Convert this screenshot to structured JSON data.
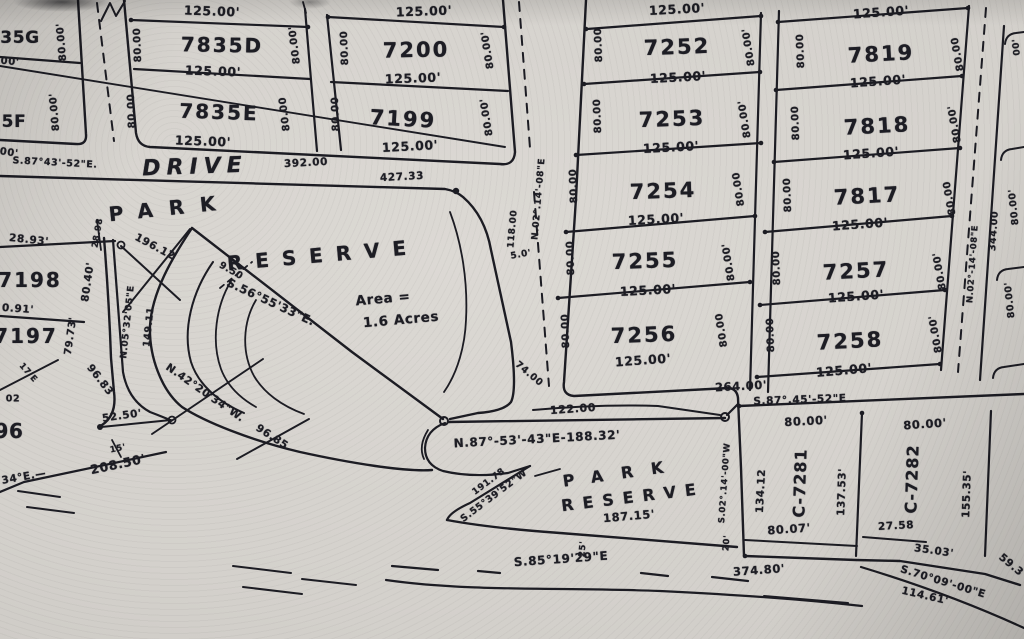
{
  "map": {
    "kind": "scanned subdivision plat map",
    "street_names_visible": [
      "DRIVE"
    ],
    "park_area_note": "Area = 1.6 Acres",
    "lot_numbers_visible": [
      "35G",
      "5F",
      "7835D",
      "7835E",
      "7200",
      "7199",
      "7252",
      "7253",
      "7254",
      "7255",
      "7256",
      "7819",
      "7818",
      "7817",
      "7257",
      "7258",
      "7198",
      "7197",
      "96",
      "C-7281",
      "C-7282"
    ],
    "ink_color": "#1c1c23",
    "paper_color": "#d4d1cc"
  },
  "labels": [
    {
      "t": "35G",
      "x": 20,
      "y": 38,
      "r": 0,
      "s": 17,
      "n": "lot-number-35g"
    },
    {
      "t": "00'",
      "x": 10,
      "y": 62,
      "r": 5,
      "s": 10
    },
    {
      "t": "80.00'",
      "x": 62,
      "y": 42,
      "r": -95,
      "s": 10
    },
    {
      "t": "5F",
      "x": 14,
      "y": 122,
      "r": 0,
      "s": 17,
      "n": "lot-number-5f"
    },
    {
      "t": "00'",
      "x": 9,
      "y": 153,
      "r": 8,
      "s": 10
    },
    {
      "t": "80.00'",
      "x": 55,
      "y": 112,
      "r": -95,
      "s": 10
    },
    {
      "t": "125.00'",
      "x": 212,
      "y": 11,
      "r": 2,
      "s": 12.5
    },
    {
      "t": "7835D",
      "x": 222,
      "y": 45,
      "r": 1,
      "s": 20,
      "ls": 2,
      "n": "lot-number-7835d"
    },
    {
      "t": "80.00",
      "x": 138,
      "y": 45,
      "r": -92,
      "s": 10
    },
    {
      "t": "80.00'",
      "x": 295,
      "y": 45,
      "r": -97,
      "s": 10
    },
    {
      "t": "125.00'",
      "x": 213,
      "y": 71,
      "r": 2,
      "s": 12.5
    },
    {
      "t": "7835E",
      "x": 219,
      "y": 112,
      "r": 2,
      "s": 20,
      "ls": 2,
      "n": "lot-number-7835e"
    },
    {
      "t": "80.00",
      "x": 132,
      "y": 111,
      "r": -92,
      "s": 10
    },
    {
      "t": "80.00",
      "x": 285,
      "y": 114,
      "r": -97,
      "s": 10
    },
    {
      "t": "125.00'",
      "x": 203,
      "y": 141,
      "r": 2,
      "s": 12.5
    },
    {
      "t": "125.00'",
      "x": 424,
      "y": 11,
      "r": -2,
      "s": 12.5
    },
    {
      "t": "7200",
      "x": 416,
      "y": 50,
      "r": -1,
      "s": 21,
      "ls": 2,
      "n": "lot-number-7200"
    },
    {
      "t": "80.00",
      "x": 345,
      "y": 48,
      "r": -92,
      "s": 10
    },
    {
      "t": "80.00'",
      "x": 488,
      "y": 50,
      "r": -99,
      "s": 10
    },
    {
      "t": "125.00'",
      "x": 413,
      "y": 78,
      "r": -2,
      "s": 12.5
    },
    {
      "t": "7199",
      "x": 403,
      "y": 119,
      "r": 3,
      "s": 21,
      "ls": 2,
      "n": "lot-number-7199"
    },
    {
      "t": "80.00",
      "x": 336,
      "y": 114,
      "r": -92,
      "s": 10
    },
    {
      "t": "80.00'",
      "x": 487,
      "y": 117,
      "r": -99,
      "s": 10
    },
    {
      "t": "125.00'",
      "x": 410,
      "y": 146,
      "r": -3,
      "s": 12.5
    },
    {
      "t": "S.87°43'-52\"E.",
      "x": 55,
      "y": 163,
      "r": 3,
      "s": 9.5,
      "n": "bearing-label"
    },
    {
      "t": "DRIVE",
      "x": 195,
      "y": 167,
      "r": -2,
      "s": 22,
      "ls": 6,
      "it": 1,
      "n": "street-name-drive"
    },
    {
      "t": "392.00",
      "x": 306,
      "y": 163,
      "r": -3,
      "s": 10.5
    },
    {
      "t": "427.33",
      "x": 402,
      "y": 177,
      "r": -3,
      "s": 10.5
    },
    {
      "t": "PARK",
      "x": 170,
      "y": 208,
      "r": -6,
      "s": 20,
      "ls": 16,
      "n": "park-reserve-west-label"
    },
    {
      "t": "RESERVE",
      "x": 323,
      "y": 255,
      "r": -5,
      "s": 20,
      "ls": 13,
      "n": "park-reserve-west-label"
    },
    {
      "t": "Area =",
      "x": 383,
      "y": 299,
      "r": -5,
      "s": 13.5,
      "n": "area-label"
    },
    {
      "t": "1.6 Acres",
      "x": 401,
      "y": 320,
      "r": -5,
      "s": 13.5,
      "n": "area-label"
    },
    {
      "t": "S.56°55'33\"E.",
      "x": 271,
      "y": 302,
      "r": 25,
      "s": 11.5,
      "n": "bearing-label"
    },
    {
      "t": "196.12",
      "x": 155,
      "y": 247,
      "r": 28,
      "s": 10.5
    },
    {
      "t": "28.98",
      "x": 98,
      "y": 233,
      "r": -80,
      "s": 8.5
    },
    {
      "t": "28.93'",
      "x": 29,
      "y": 240,
      "r": 6,
      "s": 10.5
    },
    {
      "t": "7198",
      "x": 30,
      "y": 280,
      "r": 0,
      "s": 20,
      "ls": 2,
      "n": "lot-number-7198"
    },
    {
      "t": "80.40'",
      "x": 88,
      "y": 282,
      "r": -82,
      "s": 10.5
    },
    {
      "t": "0.91'",
      "x": 18,
      "y": 309,
      "r": 4,
      "s": 10.5
    },
    {
      "t": "7197",
      "x": 26,
      "y": 336,
      "r": 0,
      "s": 20,
      "ls": 2,
      "n": "lot-number-7197"
    },
    {
      "t": "79.73'",
      "x": 71,
      "y": 336,
      "r": -82,
      "s": 10
    },
    {
      "t": "N.05°32'05\"E",
      "x": 128,
      "y": 322,
      "r": -84,
      "s": 9,
      "n": "bearing-label"
    },
    {
      "t": "149.11",
      "x": 149,
      "y": 327,
      "r": -84,
      "s": 9.5
    },
    {
      "t": "9.50",
      "x": 231,
      "y": 271,
      "r": 30,
      "s": 9.5
    },
    {
      "t": "N.42°20'34\"W.",
      "x": 205,
      "y": 393,
      "r": 35,
      "s": 10.5,
      "n": "bearing-label"
    },
    {
      "t": "96.85",
      "x": 272,
      "y": 437,
      "r": 33,
      "s": 10.5
    },
    {
      "t": "96.83",
      "x": 100,
      "y": 380,
      "r": 52,
      "s": 10.5
    },
    {
      "t": "52.50'",
      "x": 122,
      "y": 416,
      "r": -8,
      "s": 10.5
    },
    {
      "t": "15'",
      "x": 118,
      "y": 449,
      "r": -12,
      "s": 8.5
    },
    {
      "t": "208.50'",
      "x": 118,
      "y": 464,
      "r": -12,
      "s": 12.5
    },
    {
      "t": "34°E.—",
      "x": 24,
      "y": 477,
      "r": -10,
      "s": 10.5
    },
    {
      "t": "17'E",
      "x": 28,
      "y": 373,
      "r": 48,
      "s": 8.5
    },
    {
      "t": "02",
      "x": 13,
      "y": 399,
      "r": 0,
      "s": 9.5
    },
    {
      "t": "96",
      "x": 9,
      "y": 431,
      "r": 0,
      "s": 20,
      "n": "lot-number-96"
    },
    {
      "t": "N.02°.14'-08\"E",
      "x": 539,
      "y": 199,
      "r": -85,
      "s": 9,
      "n": "bearing-label"
    },
    {
      "t": "118.00",
      "x": 513,
      "y": 229,
      "r": -85,
      "s": 9
    },
    {
      "t": "5.0'",
      "x": 521,
      "y": 255,
      "r": -10,
      "s": 9
    },
    {
      "t": "74.00",
      "x": 529,
      "y": 374,
      "r": 40,
      "s": 9.5
    },
    {
      "t": "122.00",
      "x": 573,
      "y": 409,
      "r": -4,
      "s": 11
    },
    {
      "t": "125.00'",
      "x": 677,
      "y": 9,
      "r": -3,
      "s": 12.5
    },
    {
      "t": "7252",
      "x": 677,
      "y": 47,
      "r": -2,
      "s": 21,
      "ls": 2,
      "n": "lot-number-7252"
    },
    {
      "t": "80.00",
      "x": 599,
      "y": 45,
      "r": -92,
      "s": 10
    },
    {
      "t": "80.00'",
      "x": 749,
      "y": 47,
      "r": -99,
      "s": 10
    },
    {
      "t": "125.00'",
      "x": 678,
      "y": 77,
      "r": -3,
      "s": 12.5
    },
    {
      "t": "7253",
      "x": 672,
      "y": 119,
      "r": -2,
      "s": 21,
      "ls": 2,
      "n": "lot-number-7253"
    },
    {
      "t": "80.00",
      "x": 598,
      "y": 116,
      "r": -92,
      "s": 10
    },
    {
      "t": "80.00'",
      "x": 745,
      "y": 119,
      "r": -99,
      "s": 10
    },
    {
      "t": "125.00'",
      "x": 671,
      "y": 147,
      "r": -3,
      "s": 12.5
    },
    {
      "t": "7254",
      "x": 663,
      "y": 191,
      "r": -2,
      "s": 21,
      "ls": 2,
      "n": "lot-number-7254"
    },
    {
      "t": "80.00",
      "x": 574,
      "y": 186,
      "r": -92,
      "s": 10
    },
    {
      "t": "80.00",
      "x": 739,
      "y": 189,
      "r": -99,
      "s": 10
    },
    {
      "t": "125.00'",
      "x": 656,
      "y": 219,
      "r": -3,
      "s": 12.5
    },
    {
      "t": "7255",
      "x": 645,
      "y": 261,
      "r": -2,
      "s": 21,
      "ls": 2,
      "n": "lot-number-7255"
    },
    {
      "t": "80.00",
      "x": 571,
      "y": 258,
      "r": -92,
      "s": 10
    },
    {
      "t": "80.00'",
      "x": 729,
      "y": 262,
      "r": -99,
      "s": 10
    },
    {
      "t": "125.00'",
      "x": 648,
      "y": 290,
      "r": -3,
      "s": 12.5
    },
    {
      "t": "7256",
      "x": 644,
      "y": 335,
      "r": -2,
      "s": 21,
      "ls": 2,
      "n": "lot-number-7256"
    },
    {
      "t": "80.00",
      "x": 566,
      "y": 331,
      "r": -92,
      "s": 10
    },
    {
      "t": "80.00",
      "x": 722,
      "y": 330,
      "r": -99,
      "s": 10
    },
    {
      "t": "125.00'",
      "x": 643,
      "y": 360,
      "r": -4,
      "s": 12.5
    },
    {
      "t": "264.00'",
      "x": 741,
      "y": 386,
      "r": -3,
      "s": 11.5
    },
    {
      "t": "S.87°.45'-52\"E",
      "x": 800,
      "y": 400,
      "r": -2,
      "s": 10.5,
      "n": "bearing-label"
    },
    {
      "t": "125.00'",
      "x": 881,
      "y": 12,
      "r": -4,
      "s": 12.5
    },
    {
      "t": "7819",
      "x": 881,
      "y": 54,
      "r": -3,
      "s": 21,
      "ls": 2,
      "n": "lot-number-7819"
    },
    {
      "t": "80.00",
      "x": 801,
      "y": 51,
      "r": -92,
      "s": 10
    },
    {
      "t": "80.00",
      "x": 958,
      "y": 54,
      "r": -100,
      "s": 10
    },
    {
      "t": "125.00'",
      "x": 878,
      "y": 81,
      "r": -4,
      "s": 12.5
    },
    {
      "t": "7818",
      "x": 877,
      "y": 126,
      "r": -3,
      "s": 21,
      "ls": 2,
      "n": "lot-number-7818"
    },
    {
      "t": "80.00",
      "x": 796,
      "y": 123,
      "r": -92,
      "s": 10
    },
    {
      "t": "80.00'",
      "x": 955,
      "y": 124,
      "r": -100,
      "s": 10
    },
    {
      "t": "125.00'",
      "x": 871,
      "y": 153,
      "r": -4,
      "s": 12.5
    },
    {
      "t": "7817",
      "x": 867,
      "y": 196,
      "r": -3,
      "s": 21,
      "ls": 2,
      "n": "lot-number-7817"
    },
    {
      "t": "80.00",
      "x": 788,
      "y": 195,
      "r": -92,
      "s": 10
    },
    {
      "t": "80.00",
      "x": 950,
      "y": 198,
      "r": -100,
      "s": 10
    },
    {
      "t": "125.00'",
      "x": 860,
      "y": 224,
      "r": -4,
      "s": 12.5
    },
    {
      "t": "7257",
      "x": 856,
      "y": 271,
      "r": -3,
      "s": 21,
      "ls": 2,
      "n": "lot-number-7257"
    },
    {
      "t": "80.00",
      "x": 777,
      "y": 268,
      "r": -92,
      "s": 10
    },
    {
      "t": "80.00'",
      "x": 940,
      "y": 271,
      "r": -100,
      "s": 10
    },
    {
      "t": "125.00'",
      "x": 856,
      "y": 296,
      "r": -4,
      "s": 12.5
    },
    {
      "t": "7258",
      "x": 850,
      "y": 341,
      "r": -3,
      "s": 21,
      "ls": 2,
      "n": "lot-number-7258"
    },
    {
      "t": "80.00",
      "x": 771,
      "y": 335,
      "r": -92,
      "s": 10
    },
    {
      "t": "80.00'",
      "x": 936,
      "y": 334,
      "r": -100,
      "s": 10
    },
    {
      "t": "125.00'",
      "x": 844,
      "y": 370,
      "r": -5,
      "s": 12.5
    },
    {
      "t": "N.02°-14'-08\"E",
      "x": 973,
      "y": 264,
      "r": -86,
      "s": 8.5,
      "n": "bearing-label"
    },
    {
      "t": "344.00",
      "x": 994,
      "y": 231,
      "r": -86,
      "s": 9.5
    },
    {
      "t": "80.00'",
      "x": 1014,
      "y": 207,
      "r": -96,
      "s": 9.5
    },
    {
      "t": "80.00'",
      "x": 1010,
      "y": 300,
      "r": -96,
      "s": 9.5
    },
    {
      "t": "00'",
      "x": 1017,
      "y": 47,
      "r": -96,
      "s": 9
    },
    {
      "t": "80.00'",
      "x": 806,
      "y": 421,
      "r": -3,
      "s": 11.5
    },
    {
      "t": "80.00'",
      "x": 925,
      "y": 424,
      "r": -4,
      "s": 11.5
    },
    {
      "t": "S.02°.14'-00\"W",
      "x": 725,
      "y": 483,
      "r": -86,
      "s": 8.5,
      "n": "bearing-label"
    },
    {
      "t": "134.12",
      "x": 761,
      "y": 491,
      "r": -87,
      "s": 10.5
    },
    {
      "t": "C-7281",
      "x": 800,
      "y": 483,
      "r": -88,
      "s": 16,
      "ls": 1,
      "n": "lot-number-c7281"
    },
    {
      "t": "137.53'",
      "x": 842,
      "y": 492,
      "r": -88,
      "s": 10.5
    },
    {
      "t": "C-7282",
      "x": 912,
      "y": 479,
      "r": -88,
      "s": 16,
      "ls": 1,
      "n": "lot-number-c7282"
    },
    {
      "t": "155.35'",
      "x": 967,
      "y": 494,
      "r": -88,
      "s": 10.5
    },
    {
      "t": "80.07'",
      "x": 789,
      "y": 529,
      "r": -4,
      "s": 11.5
    },
    {
      "t": "27.58",
      "x": 896,
      "y": 526,
      "r": -3,
      "s": 10.5
    },
    {
      "t": "35.03'",
      "x": 934,
      "y": 551,
      "r": 8,
      "s": 10.5
    },
    {
      "t": "59.3",
      "x": 1011,
      "y": 565,
      "r": 40,
      "s": 10.5
    },
    {
      "t": "374.80'",
      "x": 759,
      "y": 570,
      "r": -4,
      "s": 11.5
    },
    {
      "t": "S.70°09'-00\"E",
      "x": 943,
      "y": 582,
      "r": 17,
      "s": 10.5,
      "n": "bearing-label"
    },
    {
      "t": "114.61'",
      "x": 925,
      "y": 596,
      "r": 13,
      "s": 10.5
    },
    {
      "t": "25'",
      "x": 583,
      "y": 549,
      "r": -85,
      "s": 8.5
    },
    {
      "t": "20'",
      "x": 727,
      "y": 543,
      "r": -86,
      "s": 8.5
    },
    {
      "t": "N.87°-53'-43\"E-188.32'",
      "x": 537,
      "y": 439,
      "r": -3,
      "s": 12,
      "n": "bearing-label"
    },
    {
      "t": "PARK",
      "x": 622,
      "y": 473,
      "r": -8,
      "s": 16,
      "ls": 18,
      "n": "park-reserve-south-label"
    },
    {
      "t": "RESERVE",
      "x": 633,
      "y": 497,
      "r": -7,
      "s": 16,
      "ls": 9,
      "n": "park-reserve-south-label"
    },
    {
      "t": "187.15'",
      "x": 629,
      "y": 516,
      "r": -5,
      "s": 11.5
    },
    {
      "t": "S.55°39'52\"W",
      "x": 494,
      "y": 496,
      "r": -37,
      "s": 9.5,
      "n": "bearing-label"
    },
    {
      "t": "191.78",
      "x": 489,
      "y": 482,
      "r": -37,
      "s": 9
    },
    {
      "t": "S.85°19'29\"E",
      "x": 561,
      "y": 559,
      "r": -4,
      "s": 12,
      "n": "bearing-label"
    }
  ]
}
